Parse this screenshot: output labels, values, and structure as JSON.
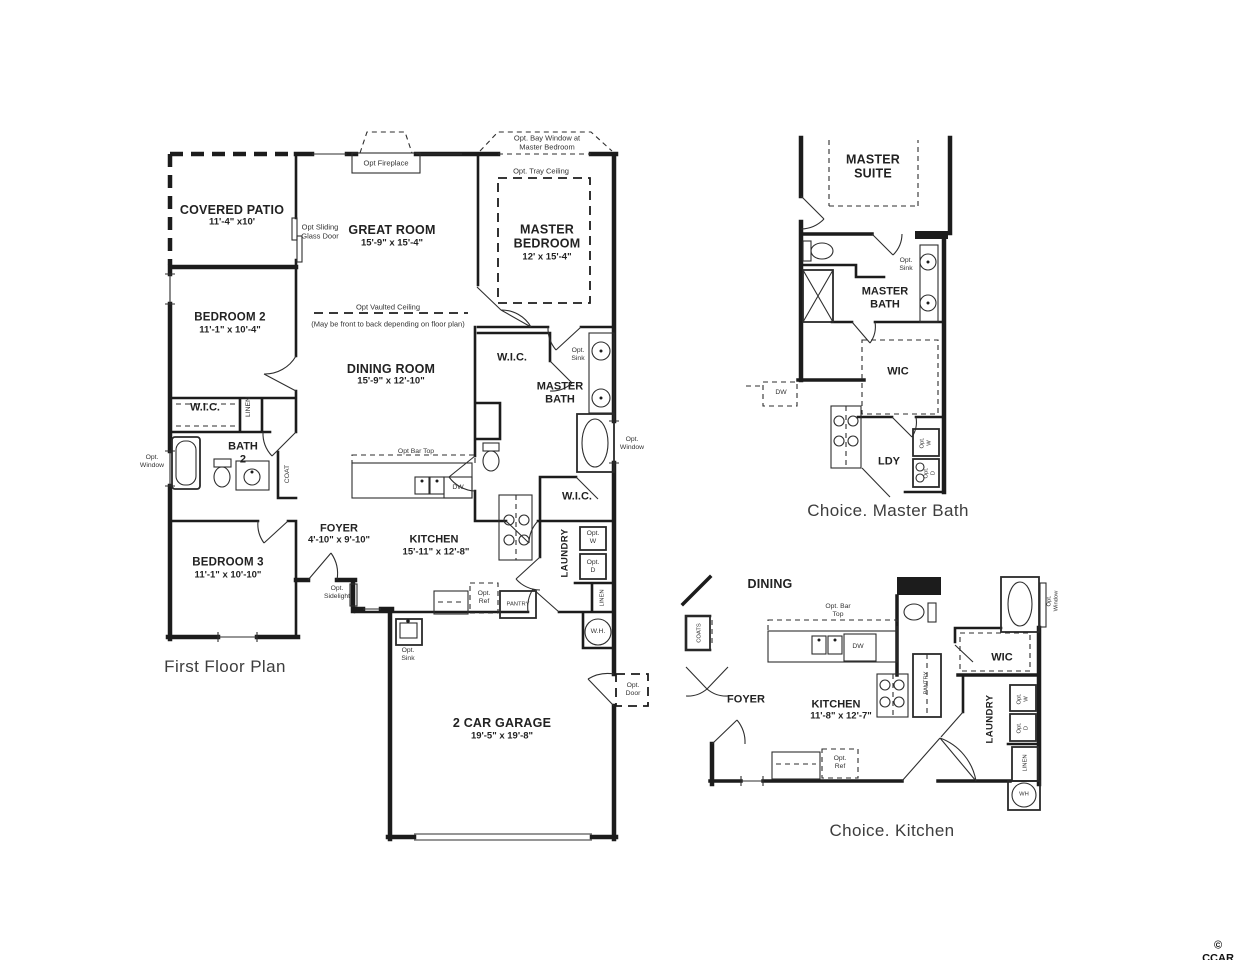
{
  "captions": {
    "first_floor": "First Floor Plan",
    "choice_master_bath": "Choice. Master Bath",
    "choice_kitchen": "Choice. Kitchen"
  },
  "watermark": "© CCAR",
  "first_floor": {
    "bay_window_note": "Opt. Bay Window at\nMaster Bedroom",
    "opt_fireplace": "Opt Fireplace",
    "opt_tray_ceiling": "Opt. Tray Ceiling",
    "covered_patio": {
      "name": "COVERED PATIO",
      "dims": "11'-4\" x10'"
    },
    "opt_sliding_door": "Opt Sliding\nGlass Door",
    "great_room": {
      "name": "GREAT ROOM",
      "dims": "15'-9\" x 15'-4\""
    },
    "master_bedroom": {
      "name": "MASTER\nBEDROOM",
      "dims": "12' x 15'-4\""
    },
    "bedroom_2": {
      "name": "BEDROOM 2",
      "dims": "11'-1\" x 10'-4\""
    },
    "opt_vaulted_ceiling": "Opt Vaulted Ceiling",
    "vaulted_note": "(May be front to back depending on floor plan)",
    "dining_room": {
      "name": "DINING ROOM",
      "dims": "15'-9\" x 12'-10\""
    },
    "wic_master": "W.I.C.",
    "opt_sink_bath": "Opt.\nSink",
    "master_bath": "MASTER\nBATH",
    "wic_bed2": "W.I.C.",
    "linen_hall": "LINEN",
    "bath_2": "BATH\n2",
    "opt_window_bath2": "Opt.\nWindow",
    "coat": "COAT",
    "opt_bar_top": "Opt Bar Top",
    "dw": "DW",
    "opt_window_master": "Opt.\nWindow",
    "wic_master2": "W.I.C.",
    "foyer": {
      "name": "FOYER",
      "dims": "4'-10\" x 9'-10\""
    },
    "kitchen": {
      "name": "KITCHEN",
      "dims": "15'-11\" x 12'-8\""
    },
    "laundry": "LAUNDRY",
    "opt_w": "Opt.\nW",
    "opt_d": "Opt.\nD",
    "bedroom_3": {
      "name": "BEDROOM 3",
      "dims": "11'-1\" x 10'-10\""
    },
    "opt_sidelight": "Opt.\nSidelight",
    "pantry": "PANTRY",
    "opt_ref": "Opt.\nRef",
    "linen_laundry": "LINEN",
    "water_heater": "W.H.",
    "opt_sink_garage": "Opt.\nSink",
    "opt_door": "Opt.\nDoor",
    "garage": {
      "name": "2 CAR GARAGE",
      "dims": "19'-5\" x 19'-8\""
    }
  },
  "choice_master_bath": {
    "master_suite": "MASTER\nSUITE",
    "opt_sink": "Opt.\nSink",
    "master_bath": "MASTER\nBATH",
    "wic": "WIC",
    "dw": "DW",
    "ldy": "LDY",
    "opt_w": "Opt.\nW",
    "opt_d": "Opt.\nD"
  },
  "choice_kitchen": {
    "dining": "DINING",
    "opt_bar_top": "Opt. Bar\nTop",
    "dw": "DW",
    "coats": "COATS",
    "opt_window": "Opt.\nWindow",
    "wic": "WIC",
    "foyer": "FOYER",
    "kitchen": {
      "name": "KITCHEN",
      "dims": "11'-8\" x 12'-7\""
    },
    "pantry": "PANTRY",
    "laundry": "LAUNDRY",
    "opt_w": "Opt.\nW",
    "opt_d": "Opt.\nD",
    "linen": "LINEN",
    "opt_ref": "Opt.\nRef",
    "wh": "WH"
  }
}
